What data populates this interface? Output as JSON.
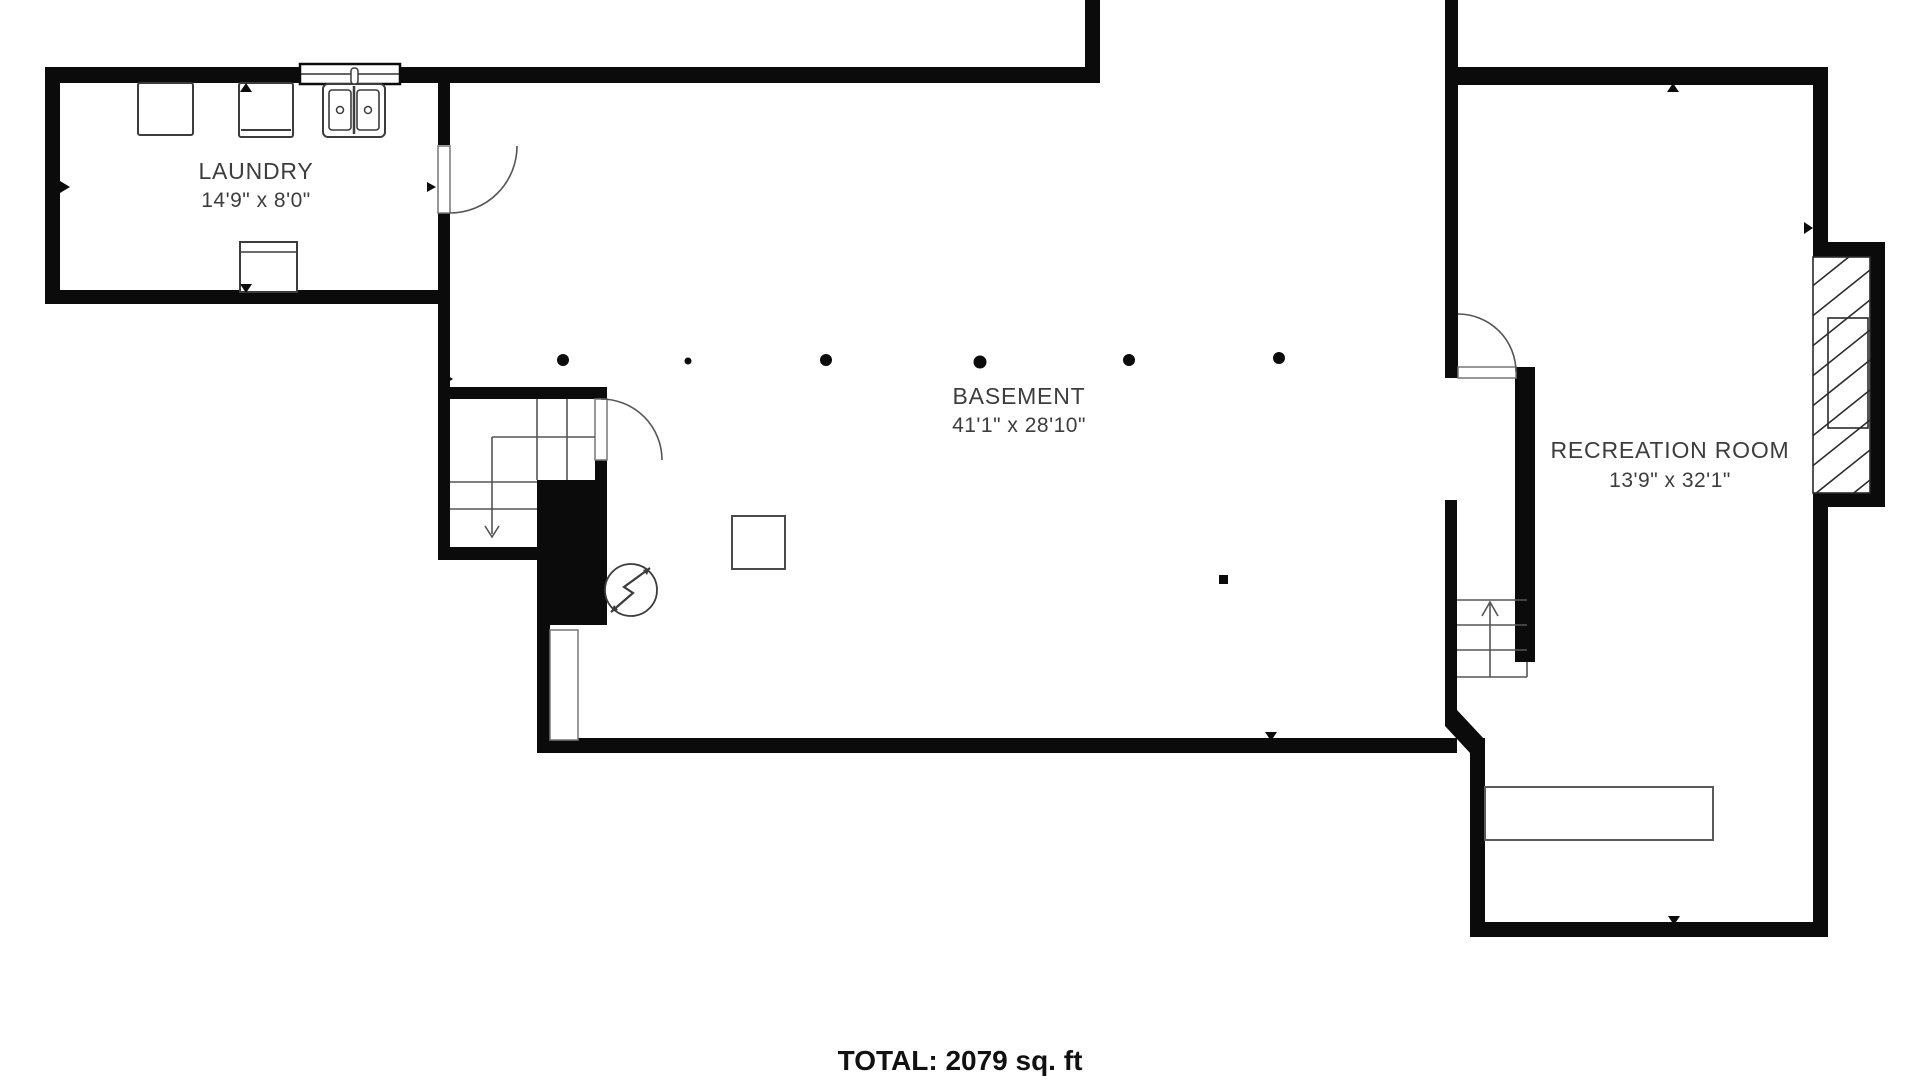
{
  "floor_plan": {
    "rooms": [
      {
        "id": "laundry",
        "label": "LAUNDRY",
        "dimensions": "14'9\" x 8'0\""
      },
      {
        "id": "basement",
        "label": "BASEMENT",
        "dimensions": "41'1\" x 28'10\""
      },
      {
        "id": "recreation",
        "label": "RECREATION ROOM",
        "dimensions": "13'9\" x 32'1\""
      }
    ],
    "total_label": "TOTAL: 2079 sq. ft",
    "colors": {
      "wall": "#0b0b0b",
      "symbol_line": "#3c3c3c",
      "thin_line": "#555555",
      "text": "#3d3d3d",
      "background": "#ffffff"
    },
    "symbols": [
      "washer",
      "dryer",
      "utility-sink",
      "window",
      "chest-freezer",
      "door-swing",
      "stairs-down",
      "stairs-up",
      "electrical-meter",
      "support-column",
      "support-post",
      "open-door-leaf",
      "bench",
      "chimney-hatch"
    ]
  }
}
